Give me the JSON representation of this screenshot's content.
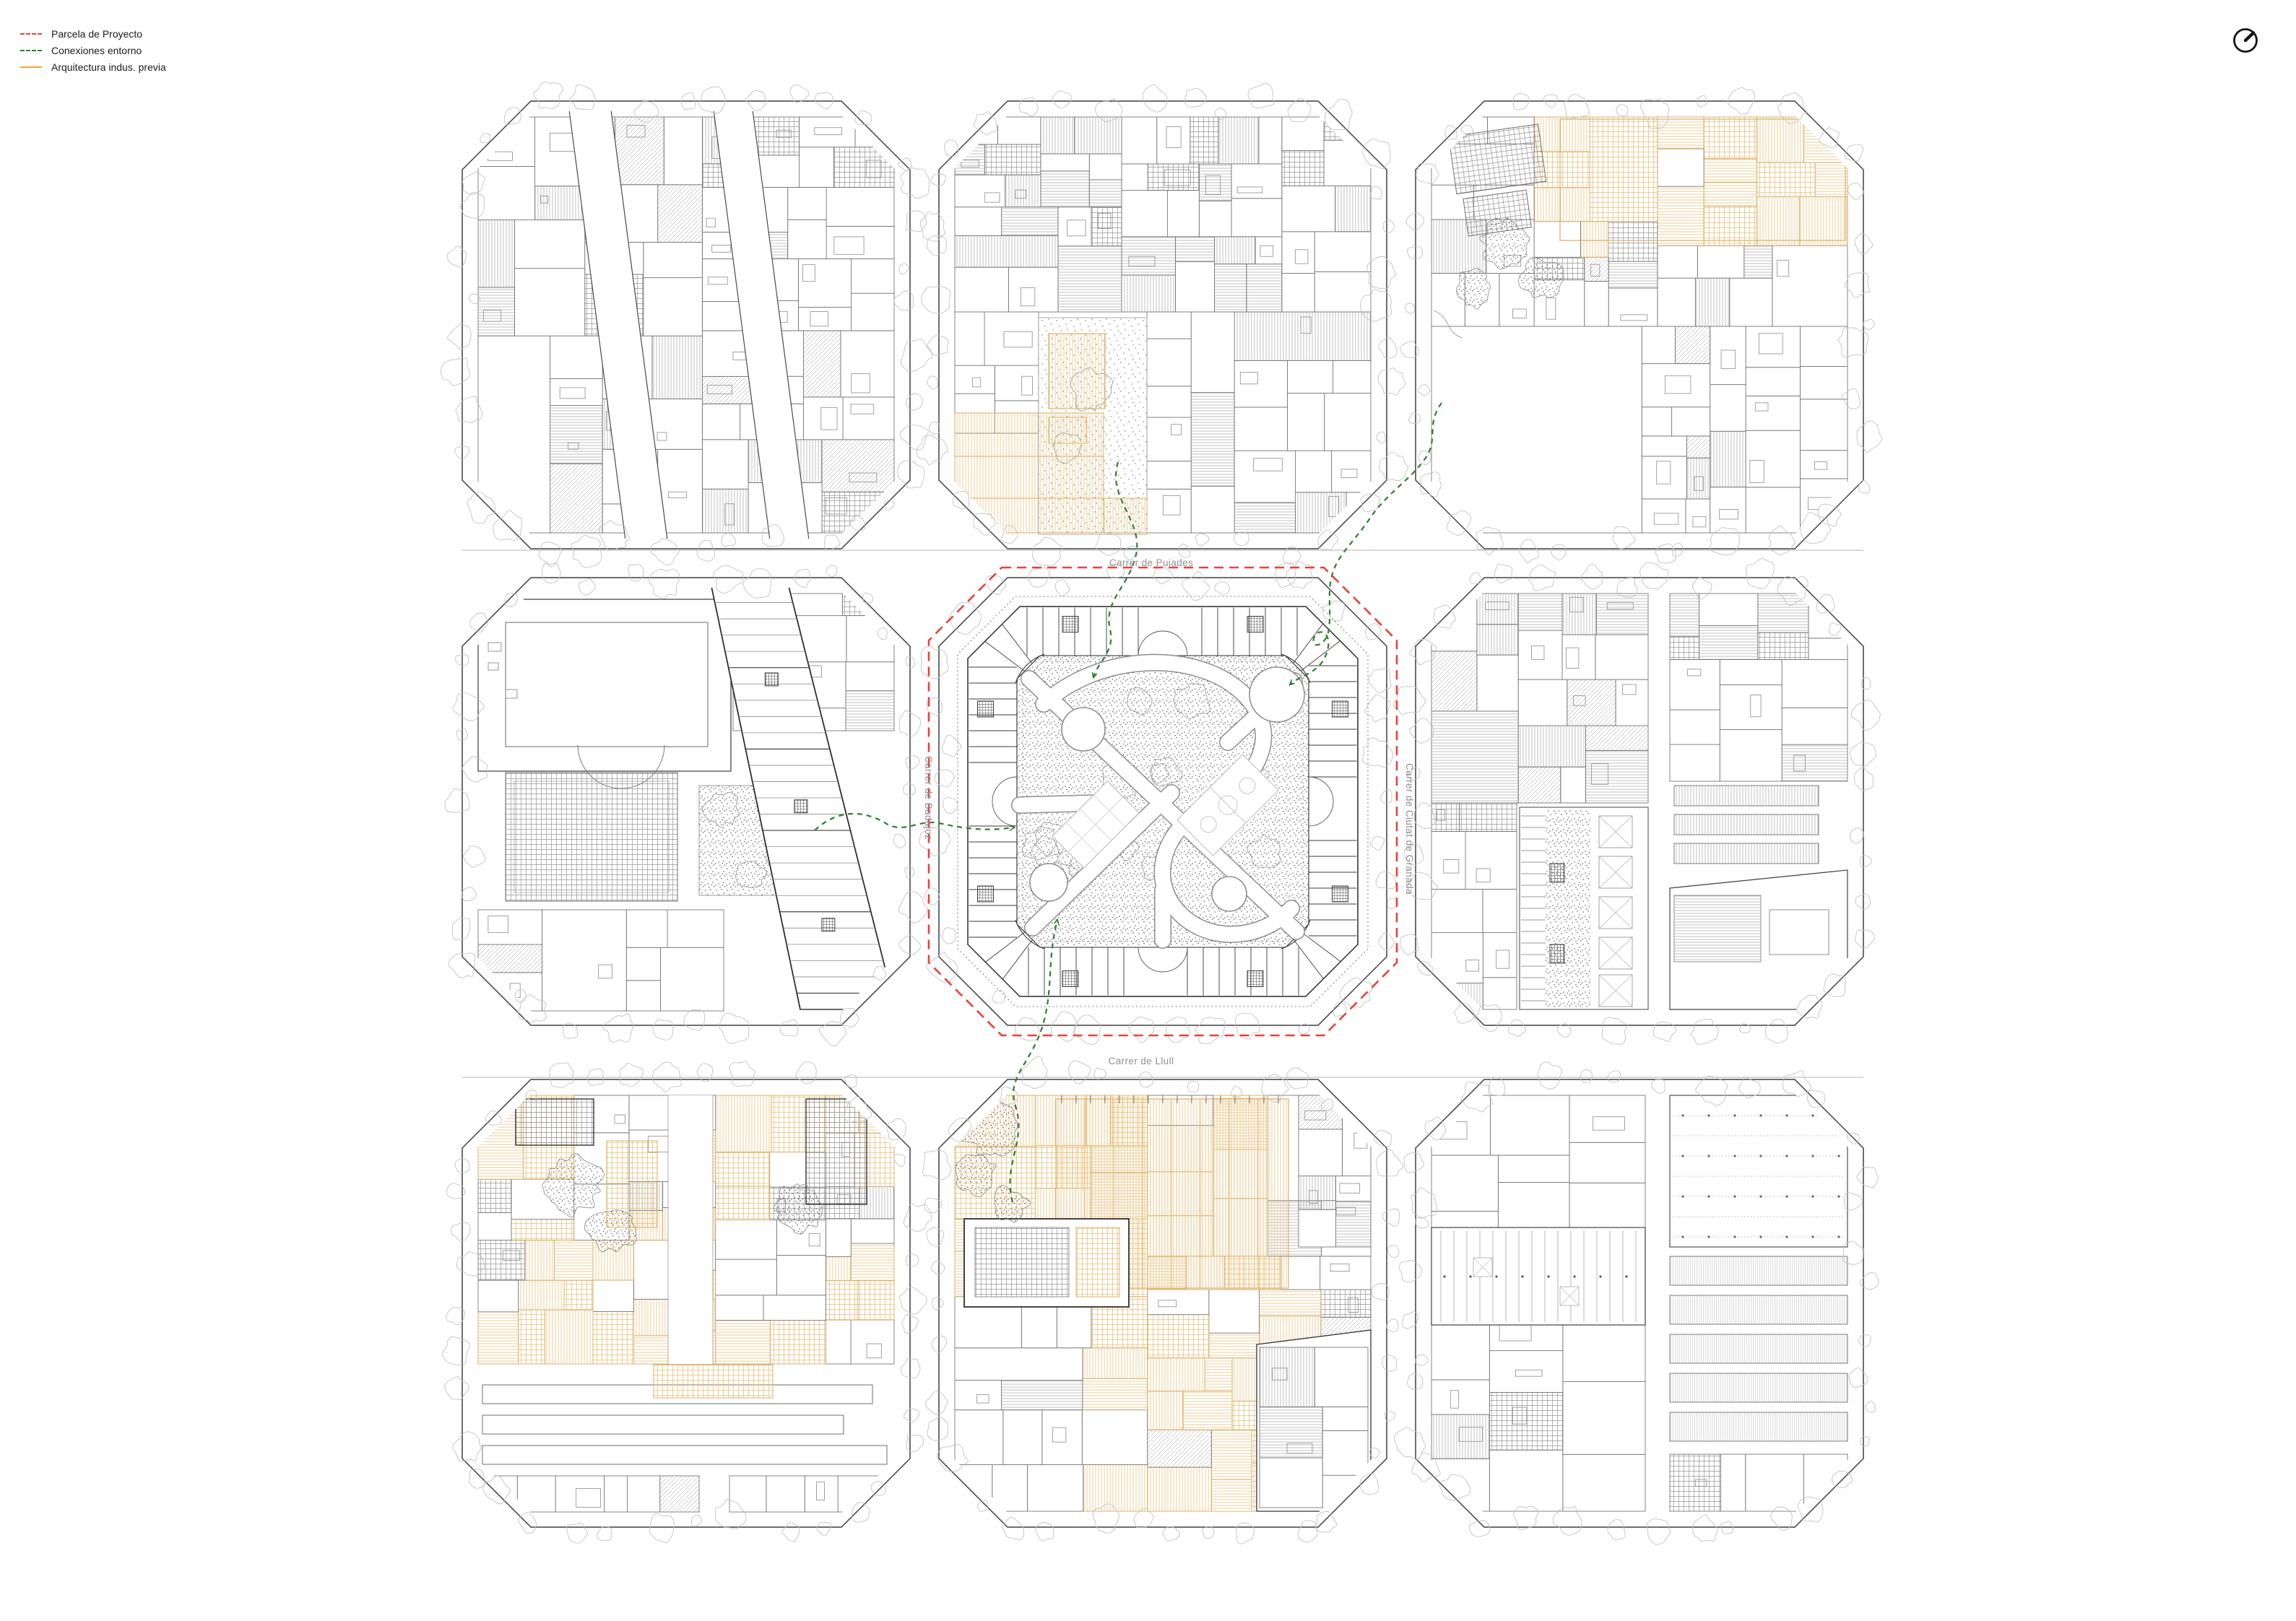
{
  "document": {
    "kind": "architectural-masterplan-sheet",
    "background": "#ffffff"
  },
  "legend": {
    "items": [
      {
        "id": "project-parcel",
        "label": "Parcela de Proyecto",
        "line_style": "dashed",
        "color": "#e8423a"
      },
      {
        "id": "context-connections",
        "label": "Conexiones entorno",
        "line_style": "dashed",
        "color": "#2e7d32"
      },
      {
        "id": "previous-industrial",
        "label": "Arquitectura indus. previa",
        "line_style": "solid",
        "color": "#f2a43c"
      }
    ]
  },
  "streets": {
    "north": "Carrer de Pujades",
    "south": "Carrer de Llull",
    "west": "Carrer de Badajoz",
    "east": "Carrer de Ciutat de Granada"
  },
  "compass": {
    "type": "north-arrow"
  },
  "grid": {
    "rows": 3,
    "cols": 3
  },
  "blocks": [
    {
      "id": "top-left",
      "row": 0,
      "col": 0,
      "project_parcel": false,
      "previous_industrial": false,
      "connected": false
    },
    {
      "id": "top-middle",
      "row": 0,
      "col": 1,
      "project_parcel": false,
      "previous_industrial": true,
      "connected": true
    },
    {
      "id": "top-right",
      "row": 0,
      "col": 2,
      "project_parcel": false,
      "previous_industrial": true,
      "connected": true
    },
    {
      "id": "middle-left",
      "row": 1,
      "col": 0,
      "project_parcel": false,
      "previous_industrial": false,
      "connected": true
    },
    {
      "id": "center",
      "row": 1,
      "col": 1,
      "project_parcel": true,
      "previous_industrial": false,
      "connected": true
    },
    {
      "id": "middle-right",
      "row": 1,
      "col": 2,
      "project_parcel": false,
      "previous_industrial": false,
      "connected": false
    },
    {
      "id": "bottom-left",
      "row": 2,
      "col": 0,
      "project_parcel": false,
      "previous_industrial": true,
      "connected": false
    },
    {
      "id": "bottom-middle",
      "row": 2,
      "col": 1,
      "project_parcel": false,
      "previous_industrial": true,
      "connected": true
    },
    {
      "id": "bottom-right",
      "row": 2,
      "col": 2,
      "project_parcel": false,
      "previous_industrial": false,
      "connected": false
    }
  ],
  "connections": {
    "routes": [
      {
        "from": "top-middle",
        "to": "center"
      },
      {
        "from": "top-right",
        "to": "center"
      },
      {
        "from": "middle-left",
        "to": "center"
      },
      {
        "from": "bottom-middle",
        "to": "center"
      }
    ]
  },
  "colors": {
    "project_red": "#e8423a",
    "connection_green": "#2e7d32",
    "industrial_orange": "#f2a43c",
    "industrial_orange_light": "#e9c07a",
    "industrial_orange_stroke": "#dcaf63",
    "line_dark": "#3c3c3c",
    "line_mid": "#8a8a8a",
    "line_light": "#a8a8a8",
    "tree_gray": "#c2c2c2",
    "label_gray": "#8f8f8f",
    "stipple_dark": "#3a3a3a"
  }
}
